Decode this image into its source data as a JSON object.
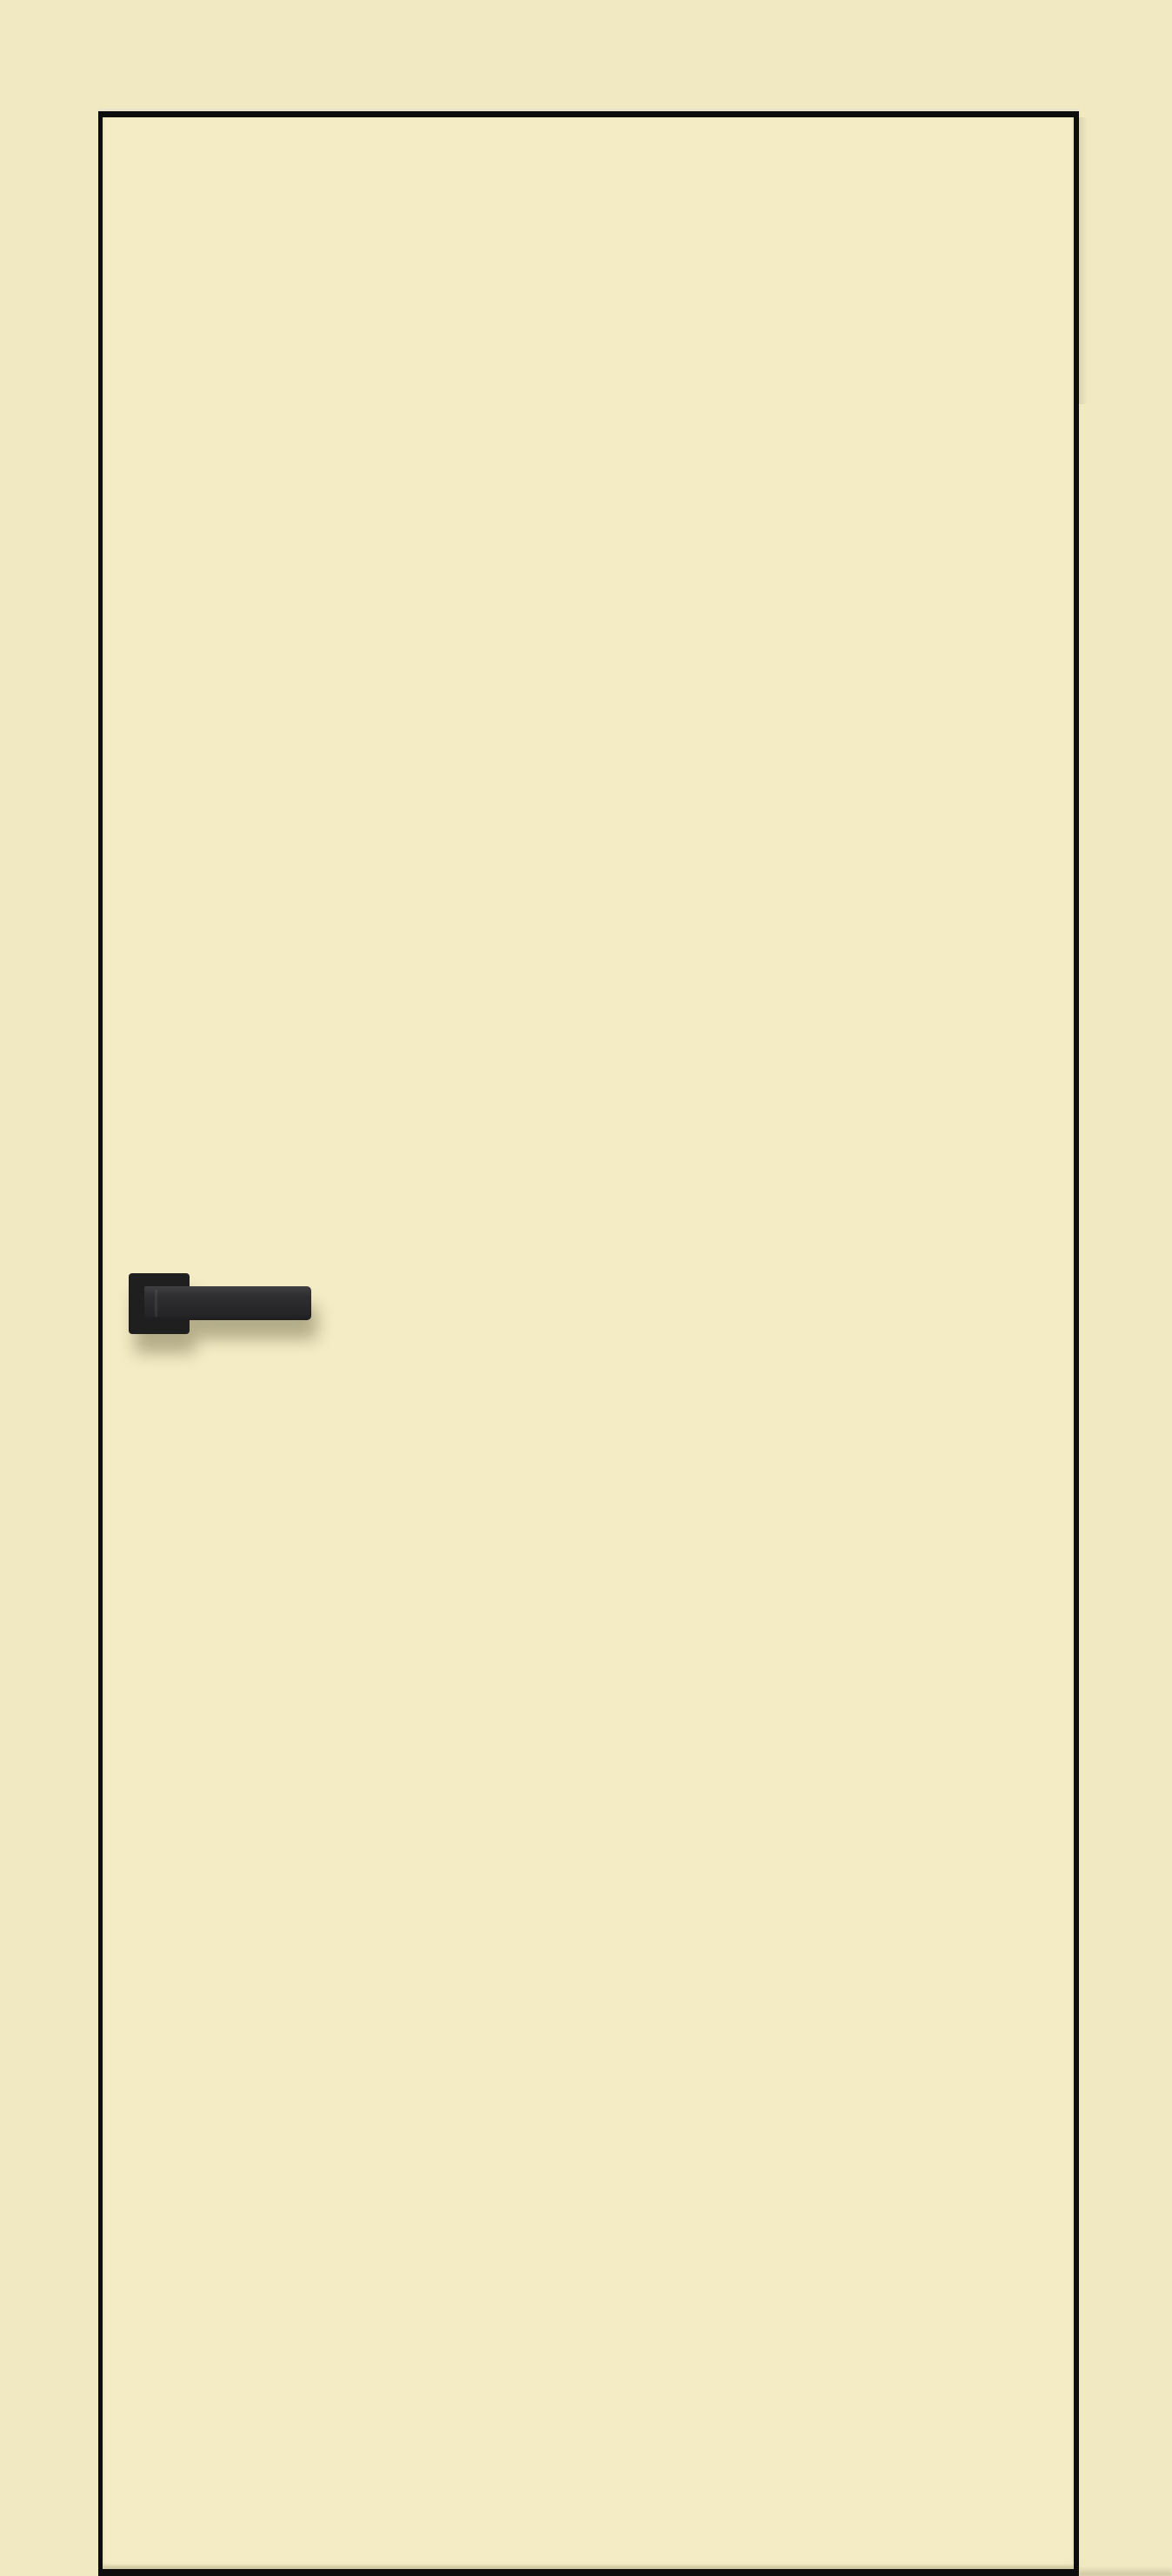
{
  "scene": {
    "description": "Product photograph of a flush interior door in an ivory/cream finish with a black square-rosette lever handle on the left side",
    "background_color": "#f1e9c1",
    "door": {
      "name": "door-leaf",
      "face_color": "#f3ecc5",
      "outline_color": "#0d0d0d"
    },
    "handle": {
      "name": "door-handle",
      "rosette_color": "#1f1f20",
      "lever_color": "#2a2a2c",
      "shadow_color": "rgba(104, 98, 62, 0.45)"
    }
  }
}
